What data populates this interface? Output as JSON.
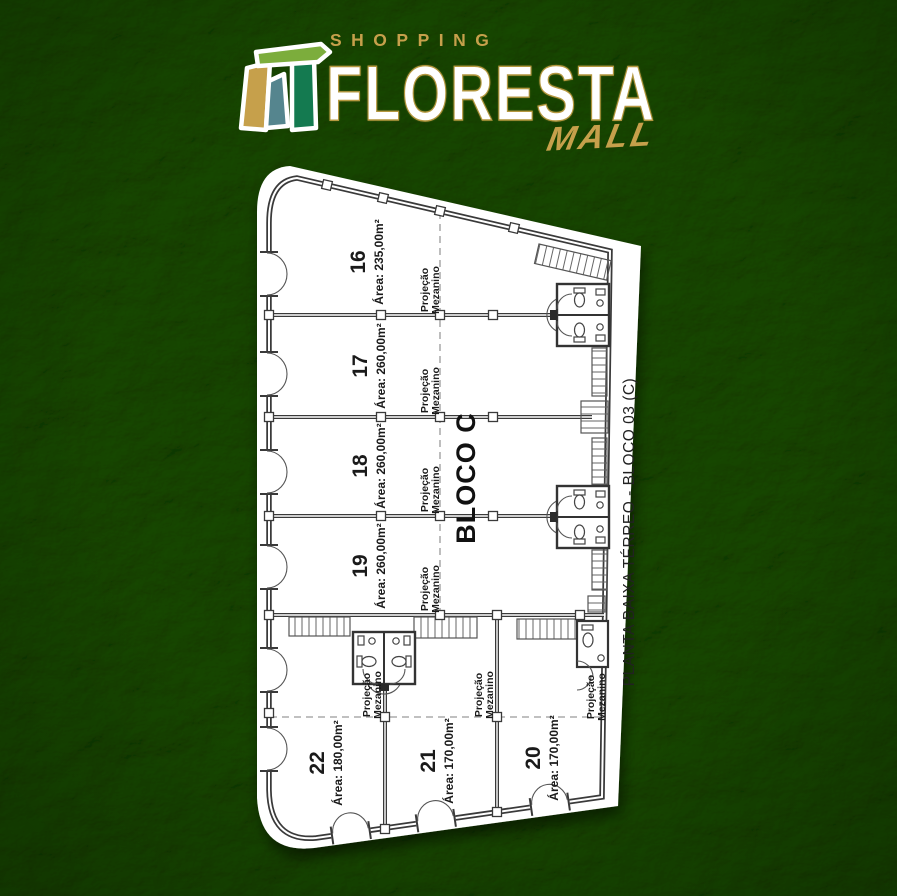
{
  "logo": {
    "shopping": "SHOPPING",
    "name": "FLORESTA",
    "mall": "MALL"
  },
  "colors": {
    "logo_gold": "#c6a04b",
    "logo_light_green": "#7cad3c",
    "logo_teal": "#55858e",
    "logo_dark_green": "#147a50",
    "plan_line": "#3a3a3a",
    "background_green": "#2e5a24"
  },
  "plan": {
    "vertical_title": "PLANTA BAIXA TÉRREO  - BLOCO 03 (C)",
    "block_label": "BLOCO C",
    "mezzanine_line1": "Projeção",
    "mezzanine_line2": "Mezanino",
    "units": [
      {
        "number": "16",
        "area": "Área: 235,00m²"
      },
      {
        "number": "17",
        "area": "Área: 260,00m²"
      },
      {
        "number": "18",
        "area": "Área: 260,00m²"
      },
      {
        "number": "19",
        "area": "Área: 260,00m²"
      },
      {
        "number": "22",
        "area": "Área: 180,00m²"
      },
      {
        "number": "21",
        "area": "Área: 170,00m²"
      },
      {
        "number": "20",
        "area": "Área: 170,00m²"
      }
    ]
  }
}
